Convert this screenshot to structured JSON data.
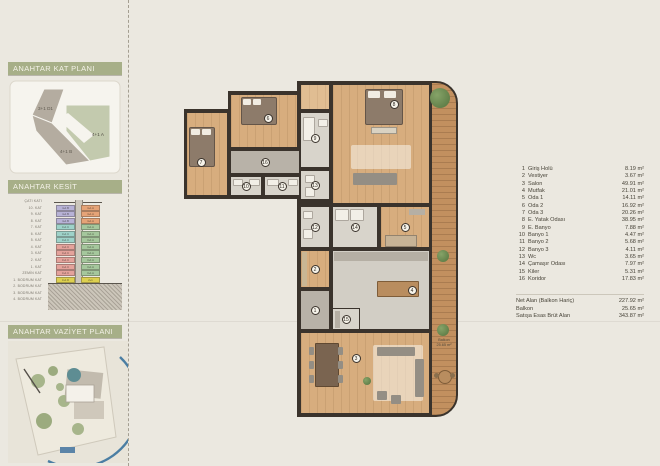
{
  "sidebar": {
    "key_plan": {
      "title": "ANAHTAR KAT PLANI",
      "units": [
        {
          "label": "3+1 D1",
          "highlighted": false
        },
        {
          "label": "4+1 B",
          "highlighted": false
        },
        {
          "label": "4+1 A",
          "highlighted": true
        }
      ],
      "highlight_color": "#c3caae",
      "muted_color": "#b4aca0"
    },
    "section": {
      "title": "ANAHTAR KESİT",
      "floors": [
        "ÇATI KATI",
        "10. KAT",
        "9. KAT",
        "8. KAT",
        "7. KAT",
        "6. KAT",
        "5. KAT",
        "4. KAT",
        "3. KAT",
        "2. KAT",
        "1. KAT",
        "ZEMİN KAT",
        "1. BODRUM KAT",
        "2. BODRUM KAT",
        "3. BODRUM KAT",
        "4. BODRUM KAT"
      ],
      "left_column": [
        {
          "label": "4+1 B",
          "color": "#b7b2d6"
        },
        {
          "label": "4+1 B",
          "color": "#b7b2d6"
        },
        {
          "label": "4+1 B",
          "color": "#b7b2d6"
        },
        {
          "label": "3+1 C",
          "color": "#9ed2c9"
        },
        {
          "label": "3+1 C",
          "color": "#9ed2c9"
        },
        {
          "label": "3+1 C",
          "color": "#9ed2c9"
        },
        {
          "label": "3+1 C",
          "color": "#e4a29b"
        },
        {
          "label": "3+1 C",
          "color": "#e4a29b"
        },
        {
          "label": "3+1 C",
          "color": "#e4a29b"
        },
        {
          "label": "3+1 C",
          "color": "#e4a29b"
        },
        {
          "label": "3+1 C",
          "color": "#e4a29b"
        },
        {
          "label": "3+1 D",
          "color": "#ddd04f"
        }
      ],
      "right_column": [
        {
          "label": "4+1 A",
          "color": "#e5a377"
        },
        {
          "label": "4+1 A",
          "color": "#e5a377"
        },
        {
          "label": "4+1 A",
          "color": "#e5a377"
        },
        {
          "label": "3+1 A",
          "color": "#a5c79c"
        },
        {
          "label": "3+1 A",
          "color": "#a5c79c"
        },
        {
          "label": "3+1 A",
          "color": "#a5c79c"
        },
        {
          "label": "3+1 A",
          "color": "#a5c79c"
        },
        {
          "label": "3+1 A",
          "color": "#a5c79c"
        },
        {
          "label": "3+1 A",
          "color": "#a5c79c"
        },
        {
          "label": "3+1 A",
          "color": "#a5c79c"
        },
        {
          "label": "3+1 A",
          "color": "#a5c79c"
        },
        {
          "label": "2+1",
          "color": "#ddd04f"
        }
      ]
    },
    "site_plan": {
      "title": "ANAHTAR VAZİYET PLANI",
      "arc_color": "#4b7ea3"
    }
  },
  "plan": {
    "rooms": [
      {
        "number": "1",
        "name": "Giriş Holü"
      },
      {
        "number": "2",
        "name": "Vestiyer"
      },
      {
        "number": "3",
        "name": "Salon"
      },
      {
        "number": "4",
        "name": "Mutfak"
      },
      {
        "number": "5",
        "name": "Oda 1"
      },
      {
        "number": "6",
        "name": "Oda 2"
      },
      {
        "number": "7",
        "name": "Oda 3"
      },
      {
        "number": "8",
        "name": "E. Yatak Odası"
      },
      {
        "number": "9",
        "name": "E. Banyo"
      },
      {
        "number": "10",
        "name": "Banyo 1"
      },
      {
        "number": "11",
        "name": "Banyo 2"
      },
      {
        "number": "12",
        "name": "Banyo 3"
      },
      {
        "number": "13",
        "name": "Wc"
      },
      {
        "number": "14",
        "name": "Çamaşır Odası"
      },
      {
        "number": "15",
        "name": "Kiler"
      },
      {
        "number": "16",
        "name": "Koridor"
      }
    ],
    "balcony_label": {
      "line1": "Balkon",
      "line2": "25.65 m²"
    }
  },
  "legend": {
    "rows": [
      {
        "no": "1",
        "name": "Giriş Holü",
        "area": "8.19 m²"
      },
      {
        "no": "2",
        "name": "Vestiyer",
        "area": "3.67 m²"
      },
      {
        "no": "3",
        "name": "Salon",
        "area": "49.91 m²"
      },
      {
        "no": "4",
        "name": "Mutfak",
        "area": "21.01 m²"
      },
      {
        "no": "5",
        "name": "Oda 1",
        "area": "14.11 m²"
      },
      {
        "no": "6",
        "name": "Oda 2",
        "area": "16.92 m²"
      },
      {
        "no": "7",
        "name": "Oda 3",
        "area": "20.26 m²"
      },
      {
        "no": "8",
        "name": "E. Yatak Odası",
        "area": "38.95 m²"
      },
      {
        "no": "9",
        "name": "E. Banyo",
        "area": "7.88 m²"
      },
      {
        "no": "10",
        "name": "Banyo 1",
        "area": "4.47 m²"
      },
      {
        "no": "11",
        "name": "Banyo 2",
        "area": "5.68 m²"
      },
      {
        "no": "12",
        "name": "Banyo 3",
        "area": "4.11 m²"
      },
      {
        "no": "13",
        "name": "Wc",
        "area": "3.65 m²"
      },
      {
        "no": "14",
        "name": "Çamaşır Odası",
        "area": "7.97 m²"
      },
      {
        "no": "15",
        "name": "Kiler",
        "area": "5.31 m²"
      },
      {
        "no": "16",
        "name": "Koridor",
        "area": "17.83 m²"
      }
    ],
    "totals": [
      {
        "label": "Net Alan (Balkon Hariç)",
        "value": "227.92 m²"
      },
      {
        "label": "Balkon",
        "value": "25.65 m²"
      },
      {
        "label": "Satışa Esas Brüt Alan",
        "value": "343.87 m²"
      }
    ]
  }
}
